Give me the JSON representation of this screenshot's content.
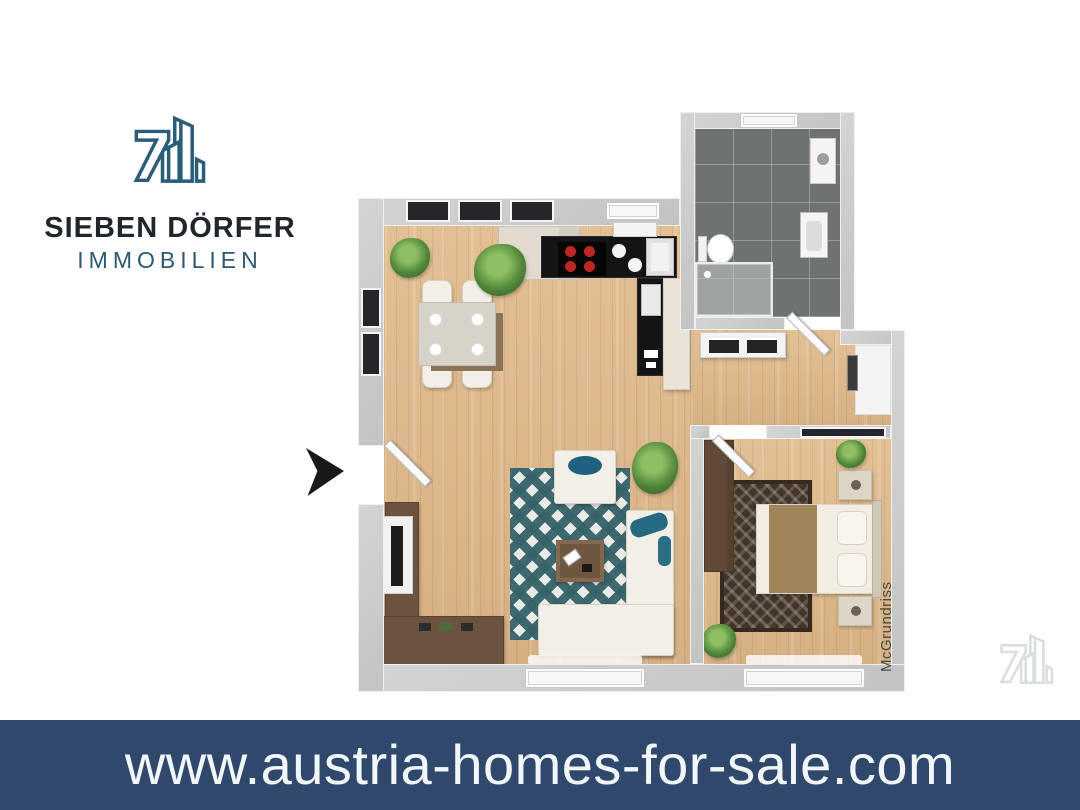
{
  "branding": {
    "agency_name": "SIEBEN DÖRFER",
    "agency_subtitle": "IMMOBILIEN",
    "logo_mark_icon": "seven-with-buildings-icon",
    "colors": {
      "mark_teal": "#2a5d78",
      "name_dark": "#20262c",
      "subtitle_teal": "#2c5a73"
    }
  },
  "floor_plan": {
    "style": "3d-top-down-render",
    "watermark": "McGrundriss",
    "entrance_marker_icon": "black-arrow-right-icon",
    "rooms": [
      {
        "name": "dining-area",
        "features": [
          "square-dining-table",
          "four-chairs",
          "four-plates",
          "corner-plants",
          "dark-framed-windows"
        ]
      },
      {
        "name": "kitchen",
        "features": [
          "l-shaped-black-counter",
          "stove-with-four-red-burners",
          "round-sink-bowls",
          "corner-sink",
          "cream-cabinets",
          "window"
        ]
      },
      {
        "name": "living-area",
        "features": [
          "teal-diamond-rug",
          "white-armchair",
          "l-shaped-white-sofa",
          "teal-cushions",
          "brown-coffee-table",
          "tv-sideboard",
          "wall-tv",
          "plant",
          "balcony-window"
        ]
      },
      {
        "name": "bathroom",
        "features": [
          "dark-gray-tile-floor",
          "toilet",
          "washbasin",
          "glass-shower",
          "washer-cabinet",
          "window",
          "angled-door"
        ]
      },
      {
        "name": "hallway",
        "features": [
          "white-dresser-dark-drawers",
          "wall-niche",
          "angled-doors"
        ]
      },
      {
        "name": "bedroom",
        "features": [
          "double-bed-brown-runner",
          "two-pillows",
          "two-nightstands",
          "dark-pattern-rug",
          "tall-wardrobe",
          "plants",
          "balcony-window",
          "closet-slot"
        ]
      }
    ],
    "colors": {
      "wood_floor": "#ddba8e",
      "bathroom_tile": "#6e7270",
      "walls": "#c8c8c8",
      "rug_teal": "#3d6a72",
      "counter_black": "#141416",
      "burner_red": "#c02620"
    }
  },
  "footer_banner": {
    "url_text": "www.austria-homes-for-sale.com",
    "background": "#2f486b",
    "text_color": "#f3f6f9"
  }
}
